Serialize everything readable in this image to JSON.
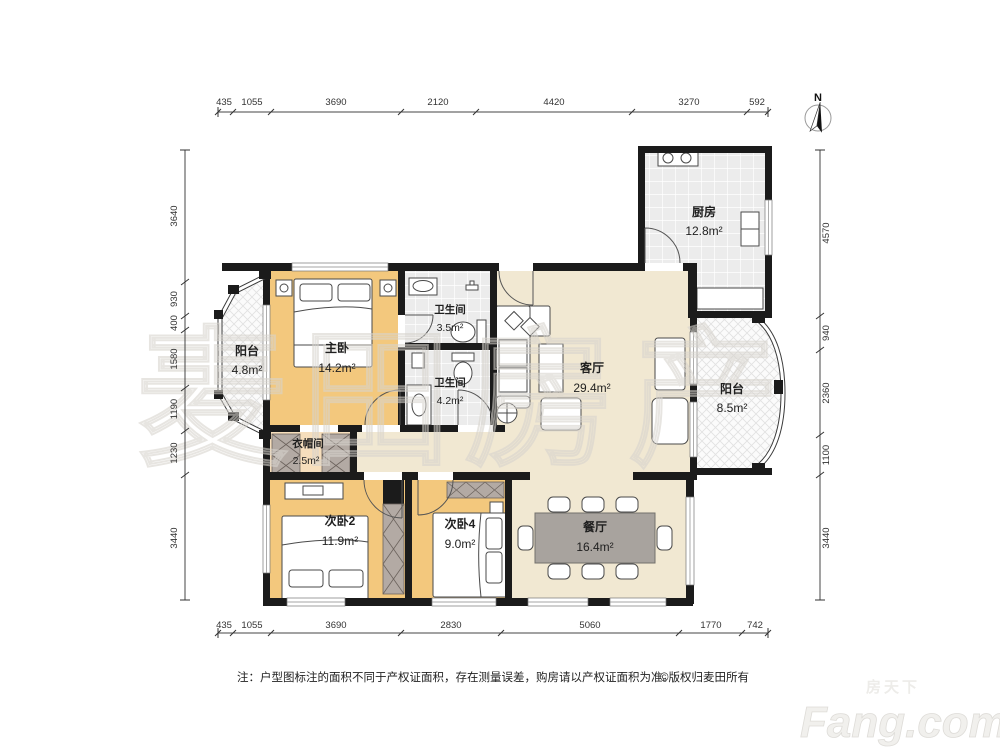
{
  "north": "N",
  "watermark": "麦田房产",
  "rooms": {
    "kitchen": {
      "name": "厨房",
      "area": "12.8m²"
    },
    "balcony_left": {
      "name": "阳台",
      "area": "4.8m²"
    },
    "master": {
      "name": "主卧",
      "area": "14.2m²"
    },
    "bath_top": {
      "name": "卫生间",
      "area": "3.5m²"
    },
    "bath_mid": {
      "name": "卫生间",
      "area": "4.2m²"
    },
    "living": {
      "name": "客厅",
      "area": "29.4m²"
    },
    "balcony_right": {
      "name": "阳台",
      "area": "8.5m²"
    },
    "cloak": {
      "name": "衣帽间",
      "area": "2.5m²"
    },
    "bed2": {
      "name": "次卧2",
      "area": "11.9m²"
    },
    "bed4": {
      "name": "次卧4",
      "area": "9.0m²"
    },
    "dining": {
      "name": "餐厅",
      "area": "16.4m²"
    }
  },
  "dimensions": {
    "top": [
      "435",
      "1055",
      "3690",
      "2120",
      "4420",
      "3270",
      "592"
    ],
    "bottom": [
      "435",
      "1055",
      "3690",
      "2830",
      "5060",
      "1770",
      "742"
    ],
    "left": [
      "3640",
      "930",
      "400",
      "1580",
      "1190",
      "1230",
      "3440"
    ],
    "right": [
      "4570",
      "940",
      "2360",
      "1100",
      "3440"
    ]
  },
  "note": {
    "prefix": "注：户型图标注的面积不同于产权证面积，存在测量误差，购房请以产权证面积为准。",
    "copyright": "©版权归麦田所有"
  },
  "brand": {
    "cn": "房天下",
    "en": "Fang.com"
  },
  "palette": {
    "wall": "#1b1b1b",
    "bedroom_floor": "#f3c87d",
    "public_floor": "#f1e8d2",
    "tile_floor": "#ececec",
    "balcony_floor": "#fbfbfb",
    "wardrobe": "#b3aaa4",
    "dining_table": "#a8a39e"
  }
}
